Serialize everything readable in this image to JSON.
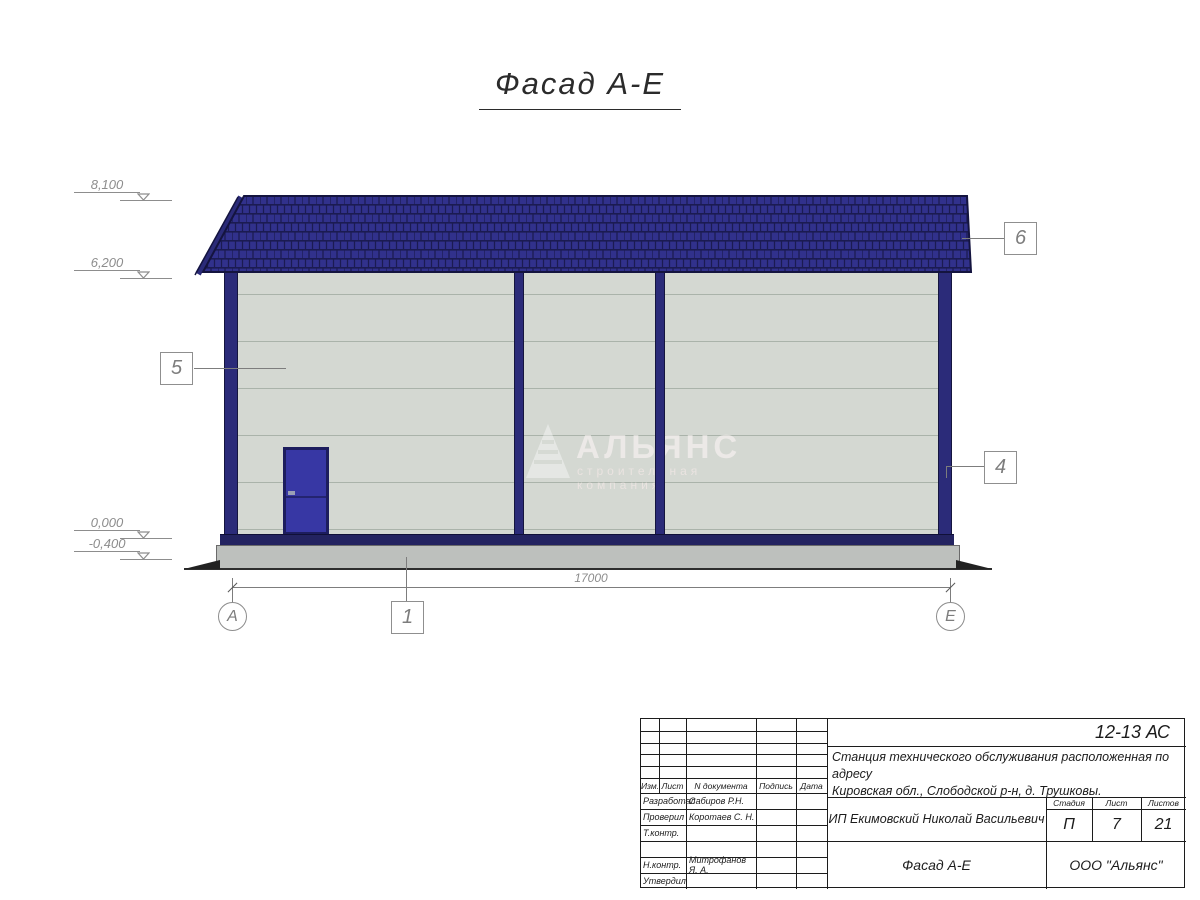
{
  "sheet": {
    "title": "Фасад А-Е"
  },
  "elevation_marks": [
    {
      "value": "8,100"
    },
    {
      "value": "6,200"
    },
    {
      "value": "0,000"
    },
    {
      "value": "-0,400"
    }
  ],
  "callouts": [
    {
      "number": "5"
    },
    {
      "number": "6"
    },
    {
      "number": "4"
    },
    {
      "number": "1"
    }
  ],
  "dimension": {
    "value": "17000"
  },
  "axes": {
    "left": "А",
    "right": "Е"
  },
  "watermark": {
    "name": "АЛЬЯНС",
    "tagline": "строительная компания"
  },
  "title_block": {
    "doc_number": "12-13 АС",
    "project_line1": "Станция технического обслуживания расположенная по адресу",
    "project_line2": "Кировская обл., Слободской р-н, д. Трушковы.",
    "client": "ИП Екимовский Николай Васильевич",
    "sheet_title": "Фасад А-Е",
    "company": "ООО \"Альянс\"",
    "header": {
      "izm": "Изм.",
      "list": "Лист",
      "doc": "N документа",
      "sign": "Подпись",
      "date": "Дата"
    },
    "staff": [
      {
        "role": "Разработал",
        "name": "Сабиров Р.Н."
      },
      {
        "role": "Проверил",
        "name": "Коротаев С. Н."
      },
      {
        "role": "Т.контр.",
        "name": ""
      },
      {
        "role": "",
        "name": ""
      },
      {
        "role": "Н.контр.",
        "name": "Митрофанов Я. А."
      },
      {
        "role": "Утвердил",
        "name": ""
      }
    ],
    "stage": {
      "label": "Стадия",
      "value": "П"
    },
    "sheet_num": {
      "label": "Лист",
      "value": "7"
    },
    "sheets_total": {
      "label": "Листов",
      "value": "21"
    }
  },
  "colors": {
    "roof": "#31318c",
    "roof_line": "#1b1b52",
    "frame": "#2b2b79",
    "wall": "#d4d8d2",
    "panel_line": "#aab3aa",
    "door": "#3737a4",
    "trim": "#232360",
    "plinth": "#bdc0bd"
  }
}
